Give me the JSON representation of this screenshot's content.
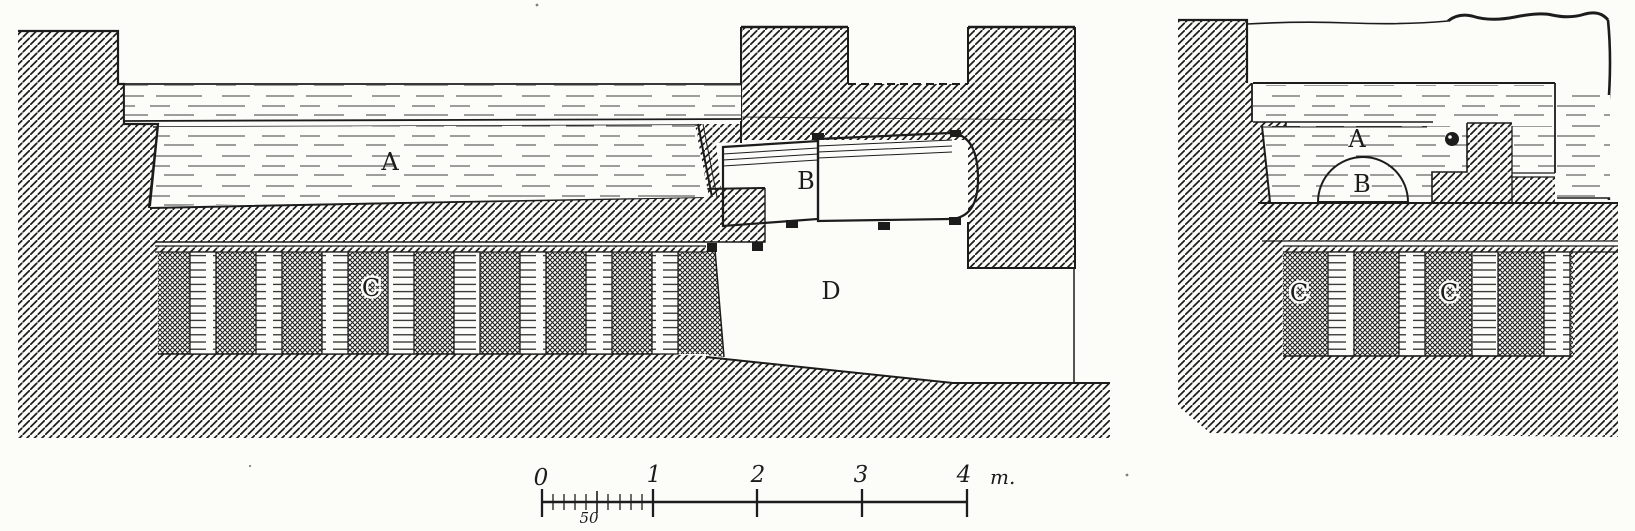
{
  "figure": {
    "type": "engraved cross-section drawing of a heated basin over a hypocaust",
    "panels": {
      "left": {
        "name": "longitudinal section",
        "labels": {
          "basin": "A",
          "boiler": "B",
          "hypocaust_pillars": "C",
          "furnace": "D"
        }
      },
      "right": {
        "name": "transverse section",
        "labels": {
          "basin": "A",
          "boiler_dome": "B",
          "hypocaust_left": "C",
          "hypocaust_right": "C"
        }
      }
    },
    "scale_bar": {
      "major_ticks": [
        "0",
        "1",
        "2",
        "3",
        "4"
      ],
      "unit_label": "m.",
      "subdivision_label": "50"
    },
    "colors": {
      "ink": "#1c1c1c",
      "paper": "#fcfcf9"
    }
  }
}
